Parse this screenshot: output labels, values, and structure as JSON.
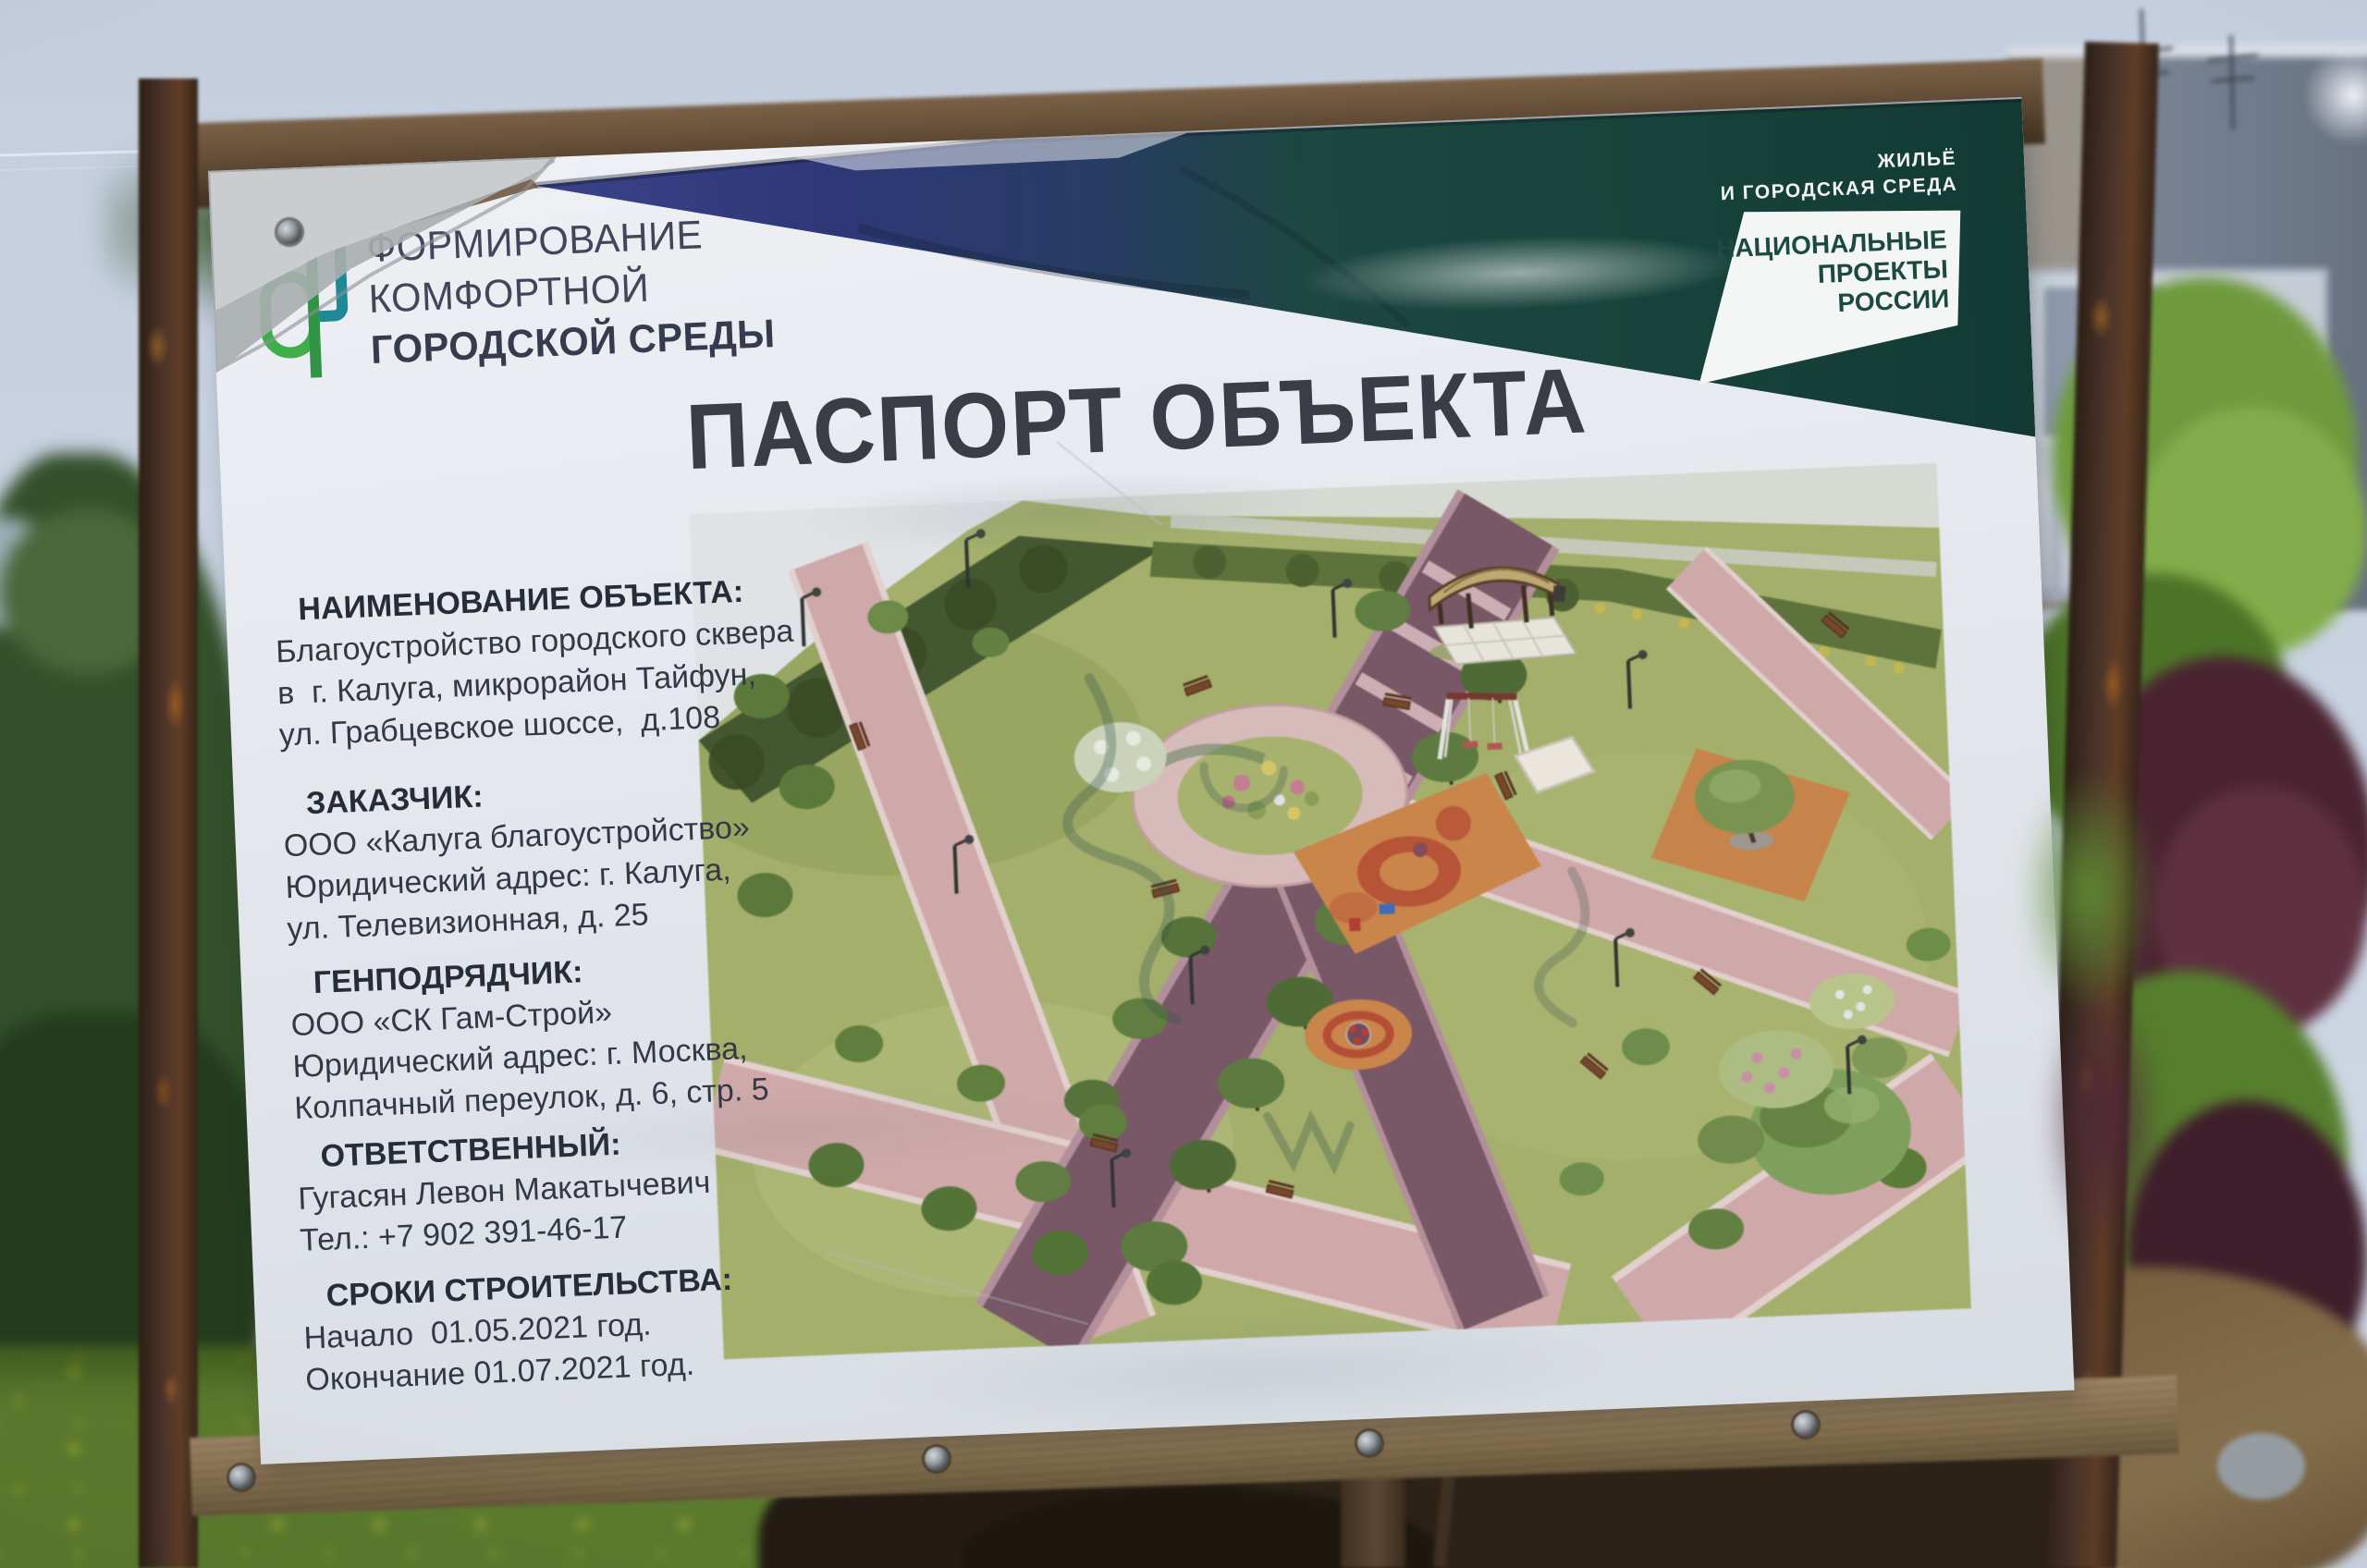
{
  "banner": {
    "program_logo": {
      "icon": "stylized-f-tree-logo",
      "lines": [
        "ФОРМИРОВАНИЕ",
        "КОМФОРТНОЙ",
        "ГОРОДСКОЙ СРЕДЫ"
      ]
    },
    "national_projects": {
      "tagline_lines": [
        "ЖИЛЬЁ",
        "И ГОРОДСКАЯ СРЕДА"
      ],
      "logo_lines": [
        "НАЦИОНАЛЬНЫЕ",
        "ПРОЕКТЫ",
        "РОССИИ"
      ]
    },
    "title": "ПАСПОРТ ОБЪЕКТА",
    "sections": [
      {
        "heading": "НАИМЕНОВАНИЕ ОБЪЕКТА:",
        "lines": [
          "Благоустройство городского сквера",
          "в  г. Калуга, микрорайон Тайфун,",
          "ул. Грабцевское шоссе,  д.108"
        ]
      },
      {
        "heading": "ЗАКАЗЧИК:",
        "lines": [
          "ООО «Калуга благоустройство»",
          "Юридический адрес: г. Калуга,",
          "ул. Телевизионная, д. 25"
        ]
      },
      {
        "heading": "ГЕНПОДРЯДЧИК:",
        "lines": [
          "ООО «СК Гам-Строй»",
          "Юридический адрес: г. Москва,",
          "Колпачный переулок, д. 6, стр. 5"
        ]
      },
      {
        "heading": "ОТВЕТСТВЕННЫЙ:",
        "lines": [
          "Гугасян Левон Макатычевич",
          "Тел.: +7 902 391-46-17"
        ]
      },
      {
        "heading": "СРОКИ СТРОИТЕЛЬСТВА:",
        "lines": [
          "Начало  01.05.2021 год.",
          "Окончание 01.07.2021 год."
        ]
      }
    ]
  },
  "colors": {
    "program_green": "#3fae49",
    "program_teal": "#1f8a96",
    "band_navy": "#2e3878",
    "band_green": "#17433a",
    "banner_white": "#e8ebef",
    "text_dark": "#333845",
    "wood": "#84704f",
    "rust": "#6e3f1d",
    "sky": "#c9d3e2",
    "grass": "#5a7b2d",
    "dandelion": "#d6c832",
    "render_lawn": "#a4b164",
    "render_path_pink": "#d5a9aa",
    "render_boulevard": "#7b5566",
    "render_playground_orange": "#d28440",
    "render_playground_red": "#bf4a2e"
  }
}
